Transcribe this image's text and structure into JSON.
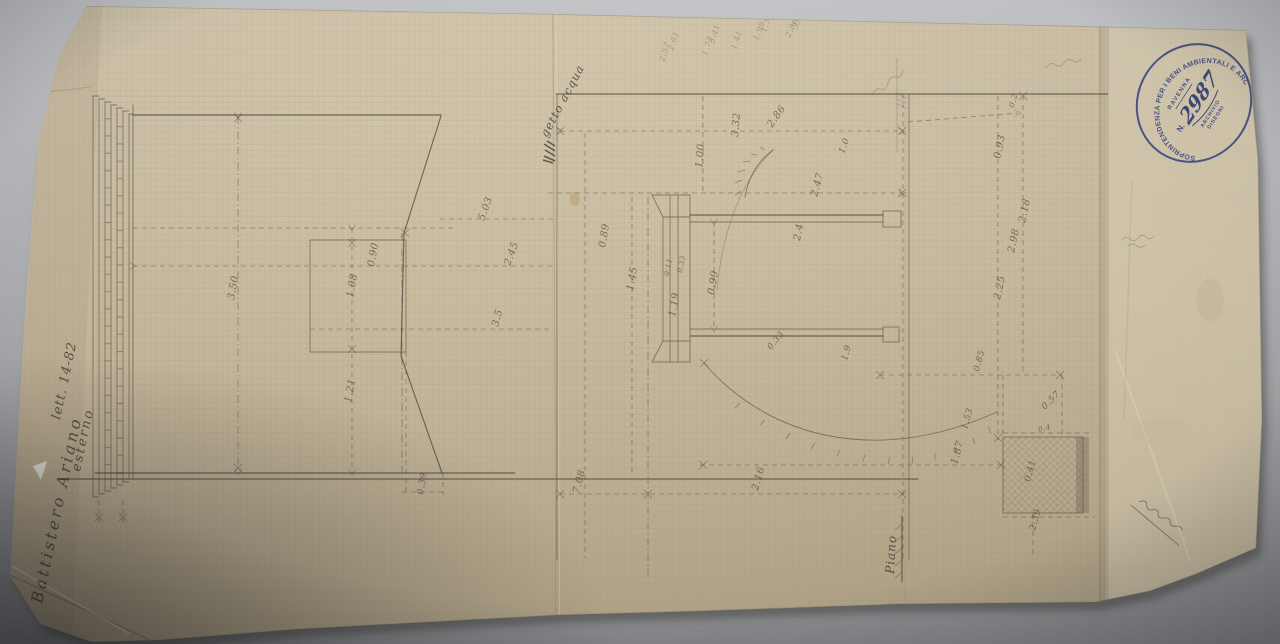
{
  "photo": {
    "backdrop_color": "#b3b5b8",
    "paper_color": "#cdc0a5",
    "pencil_color": "#4c463e",
    "ink_blue": "#32407f"
  },
  "stamp": {
    "ring_text": "SOPRINTENDENZA PER I BENI AMBIENTALI E ARCHITETTONICI",
    "city": "RAVENNA",
    "number_prefix": "N.",
    "number": "2987",
    "archive_line1": "ARCHIVIO",
    "archive_line2": "DISEGNI"
  },
  "handwriting": {
    "title": "Battistero Ariano",
    "title_line2": "esterno",
    "title_line3": "lett. 14-82",
    "water_note": "getto acqua",
    "ground_label": "Piano"
  },
  "labels": [
    {
      "text": "3.50",
      "x": 234,
      "y": 300,
      "r": -80,
      "s": 10,
      "cls": "dim"
    },
    {
      "text": "0.90",
      "x": 374,
      "y": 267,
      "r": -80,
      "s": 10,
      "cls": "dim"
    },
    {
      "text": "1.08",
      "x": 353,
      "y": 298,
      "r": -80,
      "s": 10,
      "cls": "dim"
    },
    {
      "text": "1.21",
      "x": 351,
      "y": 403,
      "r": -80,
      "s": 10,
      "cls": "dim"
    },
    {
      "text": "0.39",
      "x": 423,
      "y": 495,
      "r": -80,
      "s": 9,
      "cls": "dim"
    },
    {
      "text": "5.03",
      "x": 484,
      "y": 221,
      "r": -70,
      "s": 10,
      "cls": "dim"
    },
    {
      "text": "2.45",
      "x": 510,
      "y": 266,
      "r": -70,
      "s": 10,
      "cls": "dim"
    },
    {
      "text": "3.5",
      "x": 498,
      "y": 327,
      "r": -75,
      "s": 10,
      "cls": "dim"
    },
    {
      "text": "1.00",
      "x": 702,
      "y": 168,
      "r": -85,
      "s": 10,
      "cls": "dim"
    },
    {
      "text": "3.32",
      "x": 738,
      "y": 137,
      "r": -85,
      "s": 10,
      "cls": "dim"
    },
    {
      "text": "2.86",
      "x": 772,
      "y": 128,
      "r": -55,
      "s": 10,
      "cls": "dim"
    },
    {
      "text": "2.47",
      "x": 817,
      "y": 197,
      "r": -75,
      "s": 10,
      "cls": "dim"
    },
    {
      "text": "1.0",
      "x": 844,
      "y": 154,
      "r": -70,
      "s": 9,
      "cls": "dim"
    },
    {
      "text": "0.89",
      "x": 605,
      "y": 248,
      "r": -80,
      "s": 10,
      "cls": "dim"
    },
    {
      "text": "1.45",
      "x": 633,
      "y": 291,
      "r": -80,
      "s": 10,
      "cls": "dim"
    },
    {
      "text": "1.19",
      "x": 675,
      "y": 317,
      "r": -80,
      "s": 10,
      "cls": "dim"
    },
    {
      "text": "0.11",
      "x": 669,
      "y": 276,
      "r": -80,
      "s": 7,
      "cls": "dim"
    },
    {
      "text": "0.33",
      "x": 682,
      "y": 273,
      "r": -80,
      "s": 7,
      "cls": "dim"
    },
    {
      "text": "0.99",
      "x": 714,
      "y": 295,
      "r": -80,
      "s": 10,
      "cls": "dim"
    },
    {
      "text": "2.4",
      "x": 800,
      "y": 241,
      "r": -80,
      "s": 10,
      "cls": "dim"
    },
    {
      "text": "0.33",
      "x": 771,
      "y": 350,
      "r": -50,
      "s": 8.5,
      "cls": "dim"
    },
    {
      "text": "1.9",
      "x": 847,
      "y": 361,
      "r": -75,
      "s": 9,
      "cls": "dim"
    },
    {
      "text": "0.85",
      "x": 979,
      "y": 372,
      "r": -75,
      "s": 9,
      "cls": "dim"
    },
    {
      "text": "1.53",
      "x": 967,
      "y": 430,
      "r": -75,
      "s": 9,
      "cls": "dim"
    },
    {
      "text": "7.08",
      "x": 579,
      "y": 494,
      "r": -75,
      "s": 10,
      "cls": "dim"
    },
    {
      "text": "2.16",
      "x": 758,
      "y": 491,
      "r": -75,
      "s": 10,
      "cls": "dim"
    },
    {
      "text": "0.2",
      "x": 1014,
      "y": 108,
      "r": -75,
      "s": 8,
      "cls": "dim"
    },
    {
      "text": "0.93",
      "x": 1000,
      "y": 159,
      "r": -78,
      "s": 10,
      "cls": "dim"
    },
    {
      "text": "2.18",
      "x": 1025,
      "y": 223,
      "r": -78,
      "s": 10,
      "cls": "dim"
    },
    {
      "text": "2.98",
      "x": 1014,
      "y": 253,
      "r": -78,
      "s": 10,
      "cls": "dim"
    },
    {
      "text": "2.25",
      "x": 1000,
      "y": 300,
      "r": -78,
      "s": 10,
      "cls": "dim"
    },
    {
      "text": "0.57",
      "x": 1045,
      "y": 410,
      "r": -45,
      "s": 9,
      "cls": "dim"
    },
    {
      "text": "1.87",
      "x": 957,
      "y": 465,
      "r": -75,
      "s": 10,
      "cls": "dim"
    },
    {
      "text": "0.4",
      "x": 1039,
      "y": 432,
      "r": -15,
      "s": 7,
      "cls": "dim"
    },
    {
      "text": "0.41",
      "x": 1030,
      "y": 482,
      "r": -75,
      "s": 9,
      "cls": "dim"
    },
    {
      "text": "2.39",
      "x": 1035,
      "y": 531,
      "r": -75,
      "s": 9,
      "cls": "dim"
    },
    {
      "text": "2.57",
      "x": 664,
      "y": 62,
      "r": -72,
      "s": 8,
      "cls": "faint"
    },
    {
      "text": "2.61",
      "x": 673,
      "y": 51,
      "r": -72,
      "s": 8,
      "cls": "faint"
    },
    {
      "text": "1.73",
      "x": 707,
      "y": 56,
      "r": -72,
      "s": 8,
      "cls": "faint"
    },
    {
      "text": "5.41",
      "x": 714,
      "y": 44,
      "r": -72,
      "s": 8,
      "cls": "faint"
    },
    {
      "text": "1.41",
      "x": 736,
      "y": 50,
      "r": -72,
      "s": 8,
      "cls": "faint"
    },
    {
      "text": "1.99",
      "x": 758,
      "y": 41,
      "r": -70,
      "s": 8,
      "cls": "faint"
    },
    {
      "text": "1.74",
      "x": 766,
      "y": 33,
      "r": -70,
      "s": 8,
      "cls": "faint"
    },
    {
      "text": "2.86",
      "x": 790,
      "y": 38,
      "r": -65,
      "s": 8,
      "cls": "faint"
    },
    {
      "text": "3.46",
      "x": 797,
      "y": 29,
      "r": -65,
      "s": 8,
      "cls": "faint"
    }
  ]
}
